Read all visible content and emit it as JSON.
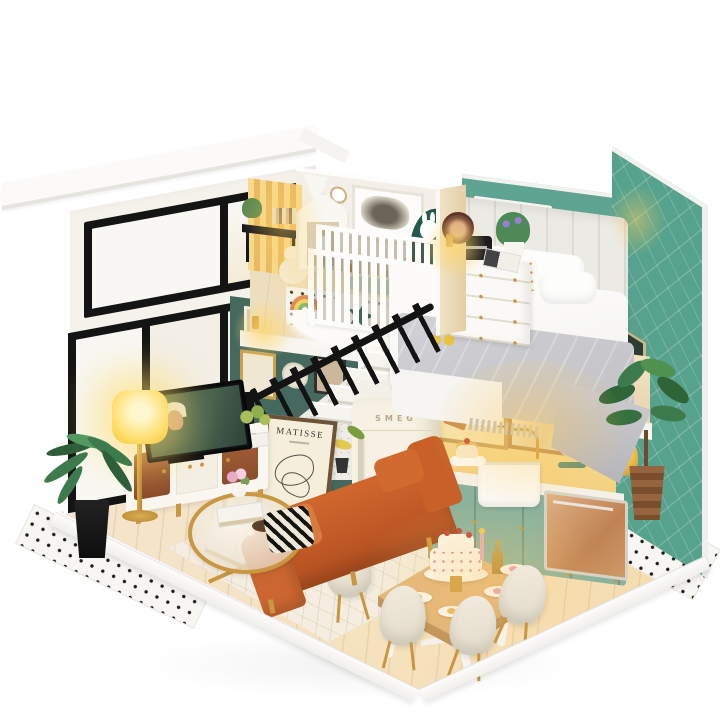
{
  "scene": {
    "description": "Product photograph of a DIY miniature dollhouse loft on a white background, shown in isometric view with two storeys: nursery and bedroom upstairs; living room, kitchen and dining room downstairs, with warm LED lighting",
    "background_color": "#ffffff"
  },
  "texts": {
    "poster_title": "MATISSE",
    "fridge_brand": "SMEG"
  },
  "colors": {
    "bg": "#ffffff",
    "roof": "#fbfaf8",
    "facade": "#f5f2ec",
    "frame": "#141414",
    "glazing": "#f8f7f4",
    "nursery_wall": "#f4f0e9",
    "mural": "#cfe2d0",
    "teal_wall": "#5fa493",
    "teal_right": "#57a28d",
    "gallery_wall": "#46695f",
    "wood_mezz": "#eedec0",
    "wood_floor": "#f3e4ca",
    "fascia": "#f7f5f0",
    "crib": "#fdfdfb",
    "headboard": "#eceae4",
    "bed": "#fcfbfa",
    "blanket": "#d2d2d6",
    "dresser": "#fbf9f5",
    "partition": "#efe2c6",
    "gold": "#c9973f",
    "sofa": "#b24f20",
    "sofa_light": "#d97b3e",
    "rug": "#f4ede0",
    "console": "#faf7f1",
    "wood_door": "#a5613a",
    "tv": "#101114",
    "tv_screen": "#46604d",
    "lamp": "#ffdb63",
    "mint": "#8ab29d",
    "counter": "#f5f1e9",
    "copper": "#c08354",
    "fridge": "#f6f1e3",
    "stairs": "#efece6",
    "railing": "#131313",
    "plant": "#3e7b4c",
    "dining_wood": "#ddae72",
    "chair": "#e2dac8",
    "cake": "#fcf8f0",
    "tile": "#f7f6f3",
    "dot": "#1d1d1a",
    "cushion_orange": "#e0893c",
    "star_teal": "#2c6a5c",
    "leaf_pillow": "#265a4e",
    "yellow_chair": "#e9b93f",
    "shade_window": "#f6f4ef",
    "radio": "#1c1c1f",
    "mixer": "#7fae92",
    "poster_bg": "#f5eeda",
    "poster_frame": "#6e5237"
  },
  "objects": [
    "white roof overhang",
    "black-framed glass facade",
    "nursery with baby crib",
    "mountain mural",
    "highland-cow art print",
    "house-shaped shelf",
    "rainbow toy",
    "sheepskin rug",
    "kids desk",
    "bedroom with channel-tufted headboard",
    "double bed with gray throw",
    "white dresser",
    "table radio",
    "roman-shade window",
    "quilted teal wall",
    "staircase with black railing",
    "gallery picture wall",
    "wall sconces",
    "retro fridge",
    "Matisse poster",
    "mint kitchen cabinets",
    "farmhouse sink",
    "gold faucet",
    "stand mixer",
    "copper dishwasher",
    "dining table with cake stand",
    "cream shell chairs",
    "orange leather sofa",
    "striped pillow",
    "gold coffee table",
    "TV console",
    "television",
    "glowing floor lamp",
    "area rug",
    "polka-dot tiles",
    "potted palm",
    "fiddle-leaf plant",
    "white display base"
  ]
}
